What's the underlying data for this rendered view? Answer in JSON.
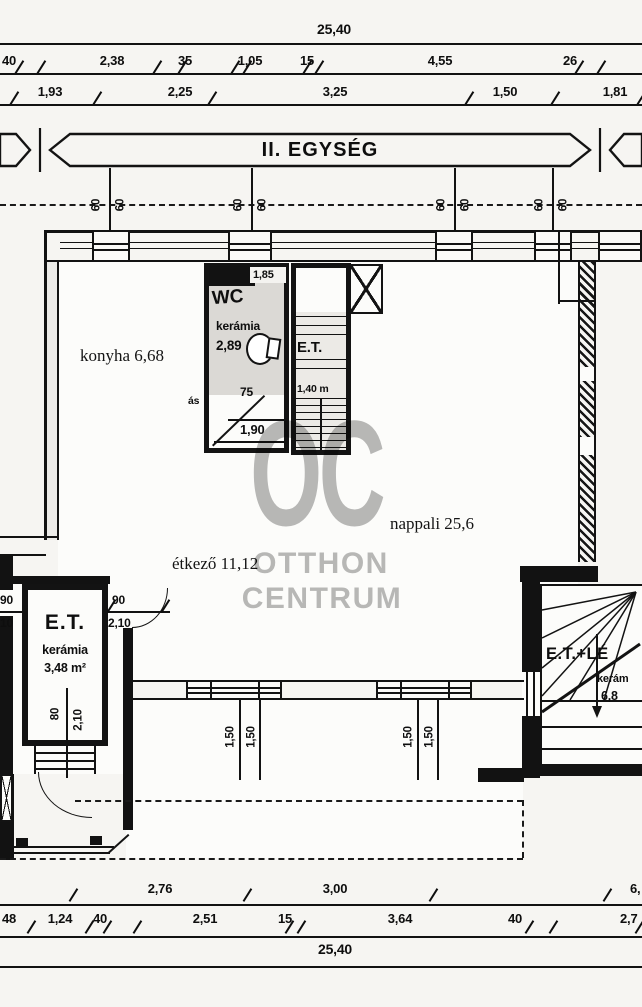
{
  "band": {
    "title": "II. EGYSÉG"
  },
  "watermark": {
    "monogram": "OC",
    "line1": "OTTHON",
    "line2": "CENTRUM",
    "color": "#b9b9b9"
  },
  "dims": {
    "top_total": "25,40",
    "row_a": [
      "40",
      "2,38",
      "35",
      "1,05",
      "15",
      "4,55",
      "26"
    ],
    "row_b": [
      "1,93",
      "2,25",
      "3,25",
      "1,50",
      "1,81"
    ],
    "module": "60",
    "window_w": "1,50",
    "bottom_a": [
      "2,76",
      "3,00",
      "6,"
    ],
    "bottom_b": [
      "48",
      "1,24",
      "40",
      "2,51",
      "15",
      "3,64",
      "40",
      "2,7"
    ],
    "bottom_total": "25,40"
  },
  "rooms": {
    "konyha": "konyha 6,68",
    "etkezo": "étkező 11,12",
    "nappali": "nappali 25,6",
    "partial": "ás",
    "wc": {
      "label": "WC",
      "top": "1,85",
      "material": "kerámia",
      "area": "2,89",
      "w": "75",
      "len": "1,90"
    },
    "et_mid": {
      "label": "E.T.",
      "depth": "1,40 m"
    },
    "et_left": {
      "label": "E.T.",
      "material": "kerámia",
      "area": "3,48 m²",
      "door_w_top": "90",
      "door_w_bottom": "10",
      "door_e_top": "90",
      "door_e_bottom": "2,10",
      "dim_a": "80",
      "dim_b": "2,10"
    },
    "et_right": {
      "label": "E.T.+LÉ",
      "material": "kerám",
      "area": "6,8"
    }
  }
}
